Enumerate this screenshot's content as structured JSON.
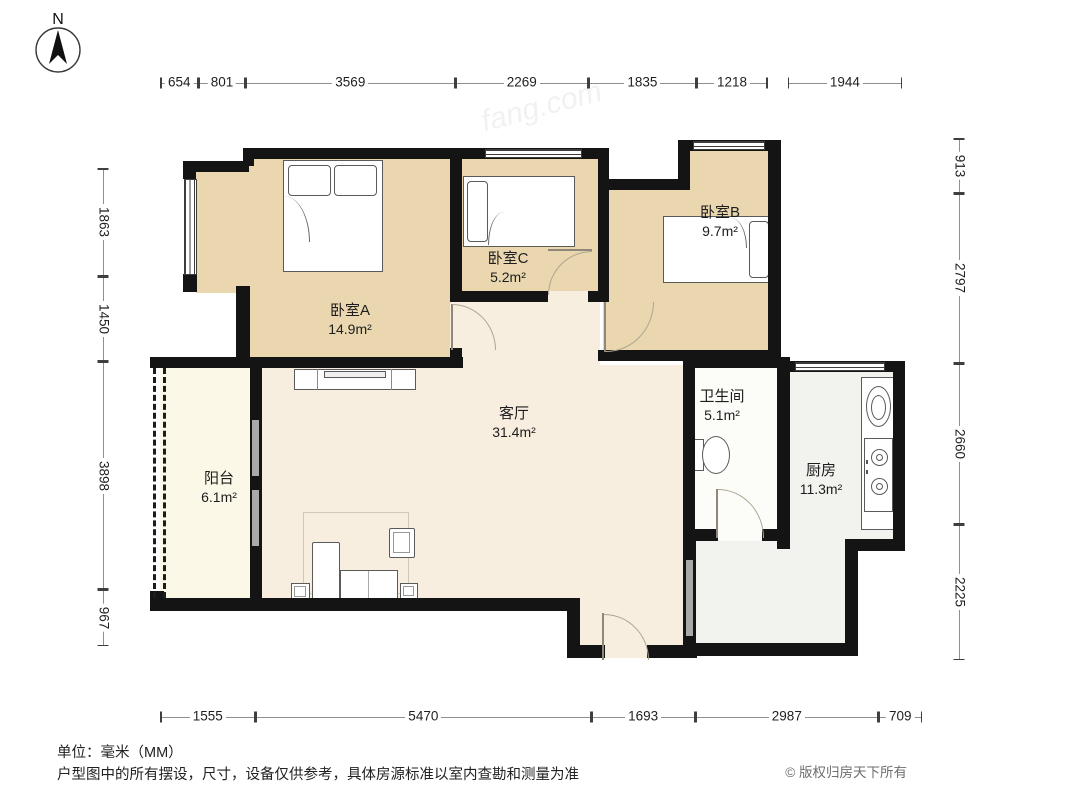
{
  "compass": {
    "label": "N"
  },
  "watermark": "fang.com",
  "rooms": [
    {
      "id": "bedroomA",
      "name": "卧室A",
      "area": "14.9m²"
    },
    {
      "id": "bedroomC",
      "name": "卧室C",
      "area": "5.2m²"
    },
    {
      "id": "bedroomB",
      "name": "卧室B",
      "area": "9.7m²"
    },
    {
      "id": "living",
      "name": "客厅",
      "area": "31.4m²"
    },
    {
      "id": "bath",
      "name": "卫生间",
      "area": "5.1m²"
    },
    {
      "id": "kitchen",
      "name": "厨房",
      "area": "11.3m²"
    },
    {
      "id": "balcony",
      "name": "阳台",
      "area": "6.1m²"
    }
  ],
  "dimensions": {
    "top": [
      654,
      801,
      3569,
      2269,
      1835,
      1218,
      1944
    ],
    "bottom": [
      1555,
      5470,
      1693,
      2987,
      709
    ],
    "left": [
      1863,
      1450,
      3898,
      967
    ],
    "right": [
      913,
      2797,
      2660,
      2225
    ]
  },
  "footer": {
    "unit_note": "单位：毫米（MM）",
    "disclaimer": "户型图中的所有摆设，尺寸，设备仅供参考，具体房源标准以室内查勘和测量为准",
    "copyright": "© 版权归房天下所有"
  },
  "colors": {
    "bedroom": "#ead7b0",
    "living": "#f8eee0",
    "balcony": "#fbf8e8",
    "bath": "#fcfcf9",
    "kitchen": "#f2f2ee",
    "wall": "#141414"
  }
}
